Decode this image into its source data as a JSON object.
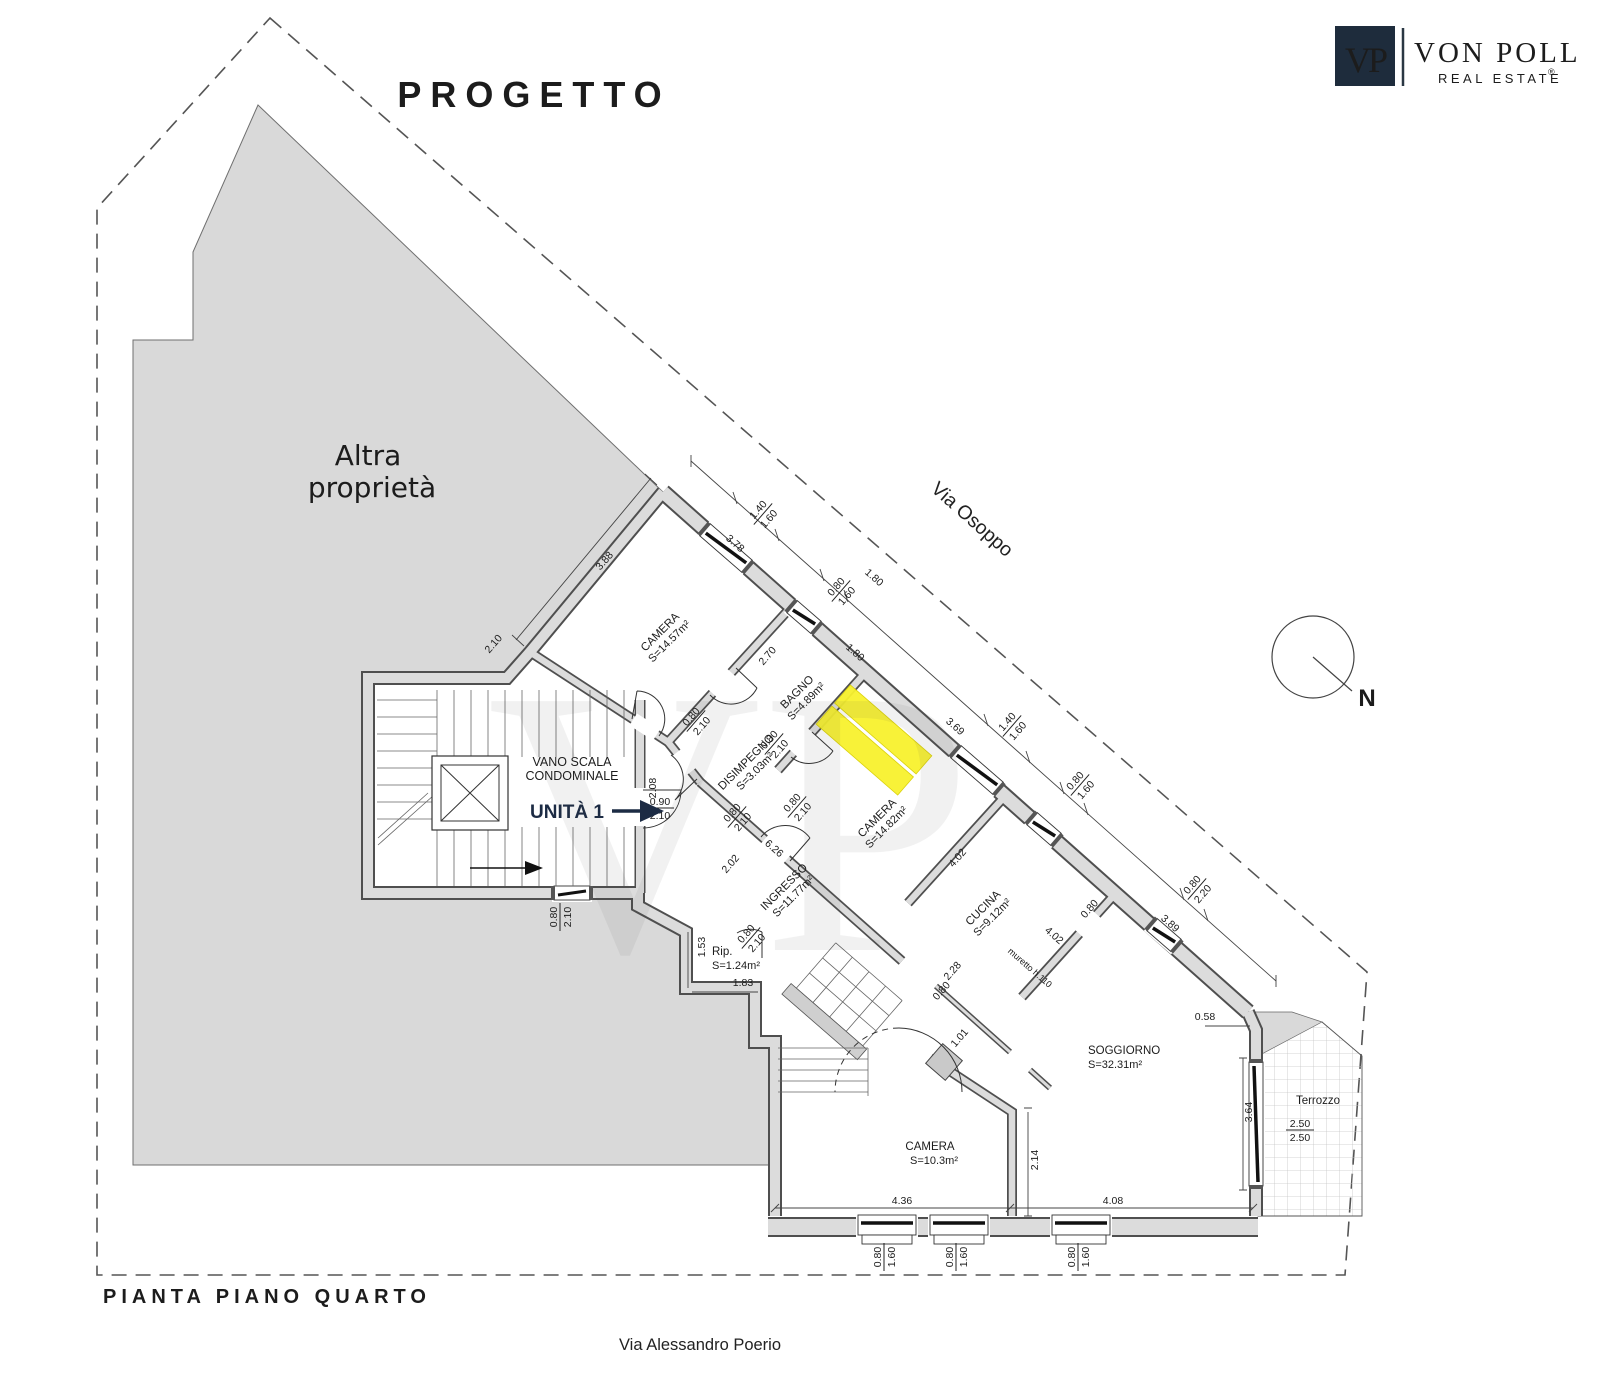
{
  "header": {
    "title": "PROGETTO"
  },
  "footer": {
    "caption": "PIANTA PIANO QUARTO",
    "street_bottom": "Via Alessandro Poerio"
  },
  "logo": {
    "monogram": "VP",
    "brand": "VON POLL",
    "tagline": "REAL ESTATE",
    "registered": "®"
  },
  "labels": {
    "other_property_1": "Altra",
    "other_property_2": "proprietà",
    "street_diagonal": "Via Osoppo",
    "compass_north": "N",
    "stairwell_1": "VANO  SCALA",
    "stairwell_2": "CONDOMINALE",
    "unit": "UNITÀ 1",
    "muretto": "muretto h.110",
    "watermark": "VP"
  },
  "rooms": [
    {
      "name": "CAMERA",
      "area": "S=14.57m²"
    },
    {
      "name": "BAGNO",
      "area": "S=4.89m²"
    },
    {
      "name": "DISIMPEGNO",
      "area": "S=3.03m²"
    },
    {
      "name": "CAMERA",
      "area": "S=14.82m²"
    },
    {
      "name": "INGRESSO",
      "area": "S=11.77m²"
    },
    {
      "name": "Rip.",
      "area": "S=1.24m²"
    },
    {
      "name": "CUCINA",
      "area": "S=9.12m²"
    },
    {
      "name": "SOGGIORNO",
      "area": "S=32.31m²"
    },
    {
      "name": "CAMERA",
      "area": "S=10.3m²"
    },
    {
      "name": "Terrozzo",
      "area": ""
    }
  ],
  "lin_dims": [
    "3.88",
    "3.78",
    "2.70",
    "1.80",
    "1.80",
    "3.69",
    "4.02",
    "4.02",
    "3.89",
    "6.26",
    "2.02",
    "1.53",
    "1.83",
    "2.28",
    "0.80",
    "0.80",
    "1.01",
    "0.58",
    "3.64",
    "2.14",
    "4.36",
    "4.08",
    "2.08",
    "2.10"
  ],
  "frac_dims": [
    {
      "t": "1.40",
      "b": "1.60"
    },
    {
      "t": "0.80",
      "b": "1.60"
    },
    {
      "t": "0.80",
      "b": "2.10"
    },
    {
      "t": "0.80",
      "b": "2.10"
    },
    {
      "t": "0.80",
      "b": "2.10"
    },
    {
      "t": "0.80",
      "b": "2.10"
    },
    {
      "t": "0.90",
      "b": "2.10"
    },
    {
      "t": "0.80",
      "b": "2.10"
    },
    {
      "t": "1.40",
      "b": "1.60"
    },
    {
      "t": "0.80",
      "b": "1.60"
    },
    {
      "t": "0.80",
      "b": "2.20"
    },
    {
      "t": "0.80",
      "b": "2.10"
    },
    {
      "t": "2.50",
      "b": "2.50"
    },
    {
      "t": "0.80",
      "b": "1.60"
    },
    {
      "t": "0.80",
      "b": "1.60"
    },
    {
      "t": "0.80",
      "b": "1.60"
    }
  ],
  "colors": {
    "navy": "#1c2b44",
    "highlight": "#f8f22e",
    "property_fill": "#d9d9d9"
  }
}
